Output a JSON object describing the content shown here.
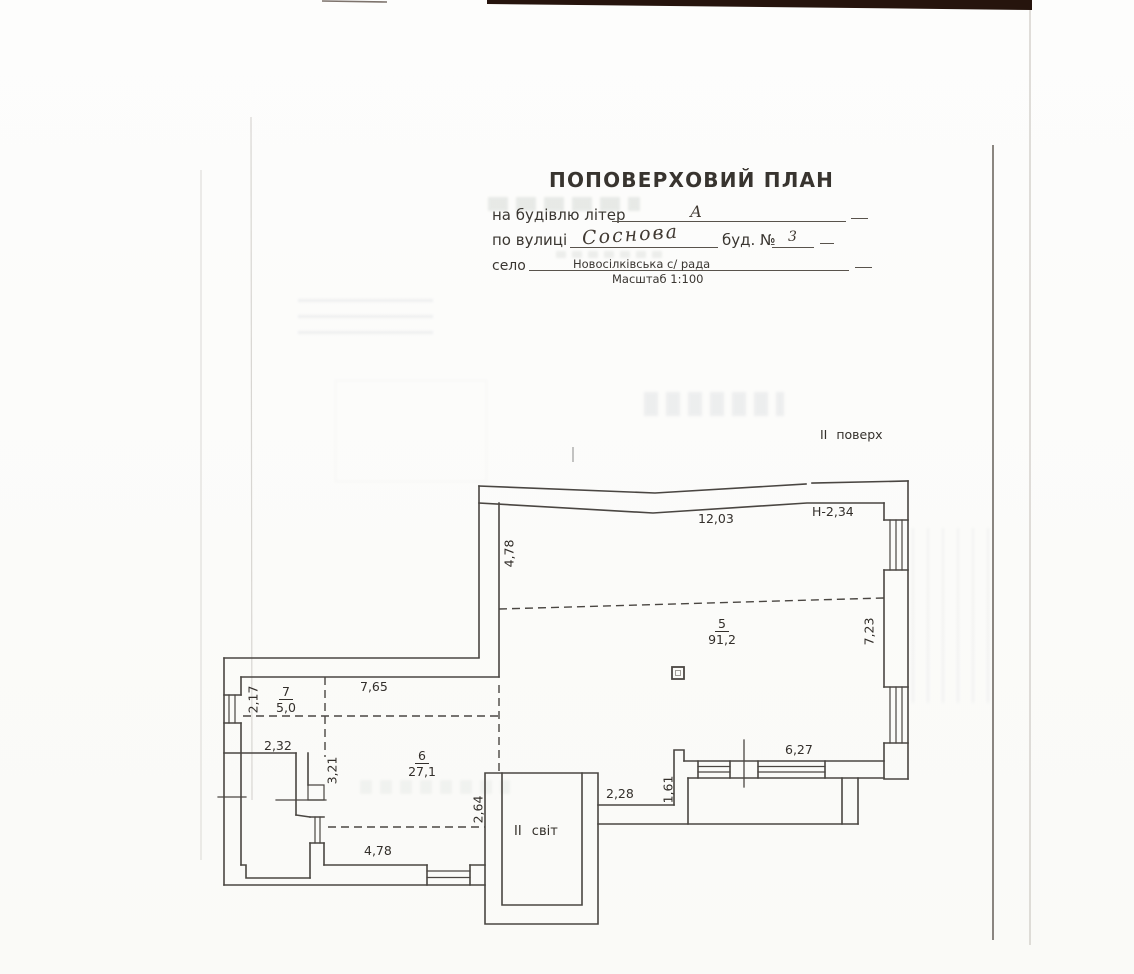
{
  "header": {
    "title": "ПОПОВЕРХОВИЙ ПЛАН",
    "building_letter_label": "на будівлю літер",
    "building_letter_value": "А",
    "street_label": "по вулиці",
    "street_value": "Соснова",
    "house_label": "буд. №",
    "house_value": "3",
    "village_label": "село",
    "village_value": "Новосілківська с/ рада",
    "scale_label": "Масштаб 1:100"
  },
  "plan": {
    "floor_label": "ІІ  поверх",
    "light_well_label": "ІІ  світ",
    "rooms": {
      "room5": {
        "number": "5",
        "area": "91,2"
      },
      "room6": {
        "number": "6",
        "area": "27,1"
      },
      "room7": {
        "number": "7",
        "area": "5,0"
      }
    },
    "dims": {
      "top_width": "12,03",
      "height_note": "Н-2,34",
      "left_upper": "4,78",
      "right_side": "7,23",
      "wing_top": "7,65",
      "wing_left": "2,17",
      "wing_inner": "2,32",
      "wing_vert": "3,21",
      "lightwell_side": "2,64",
      "corridor_width": "2,28",
      "notch_height": "1,61",
      "bottom_right": "6,27",
      "wing_bottom": "4,78"
    }
  }
}
